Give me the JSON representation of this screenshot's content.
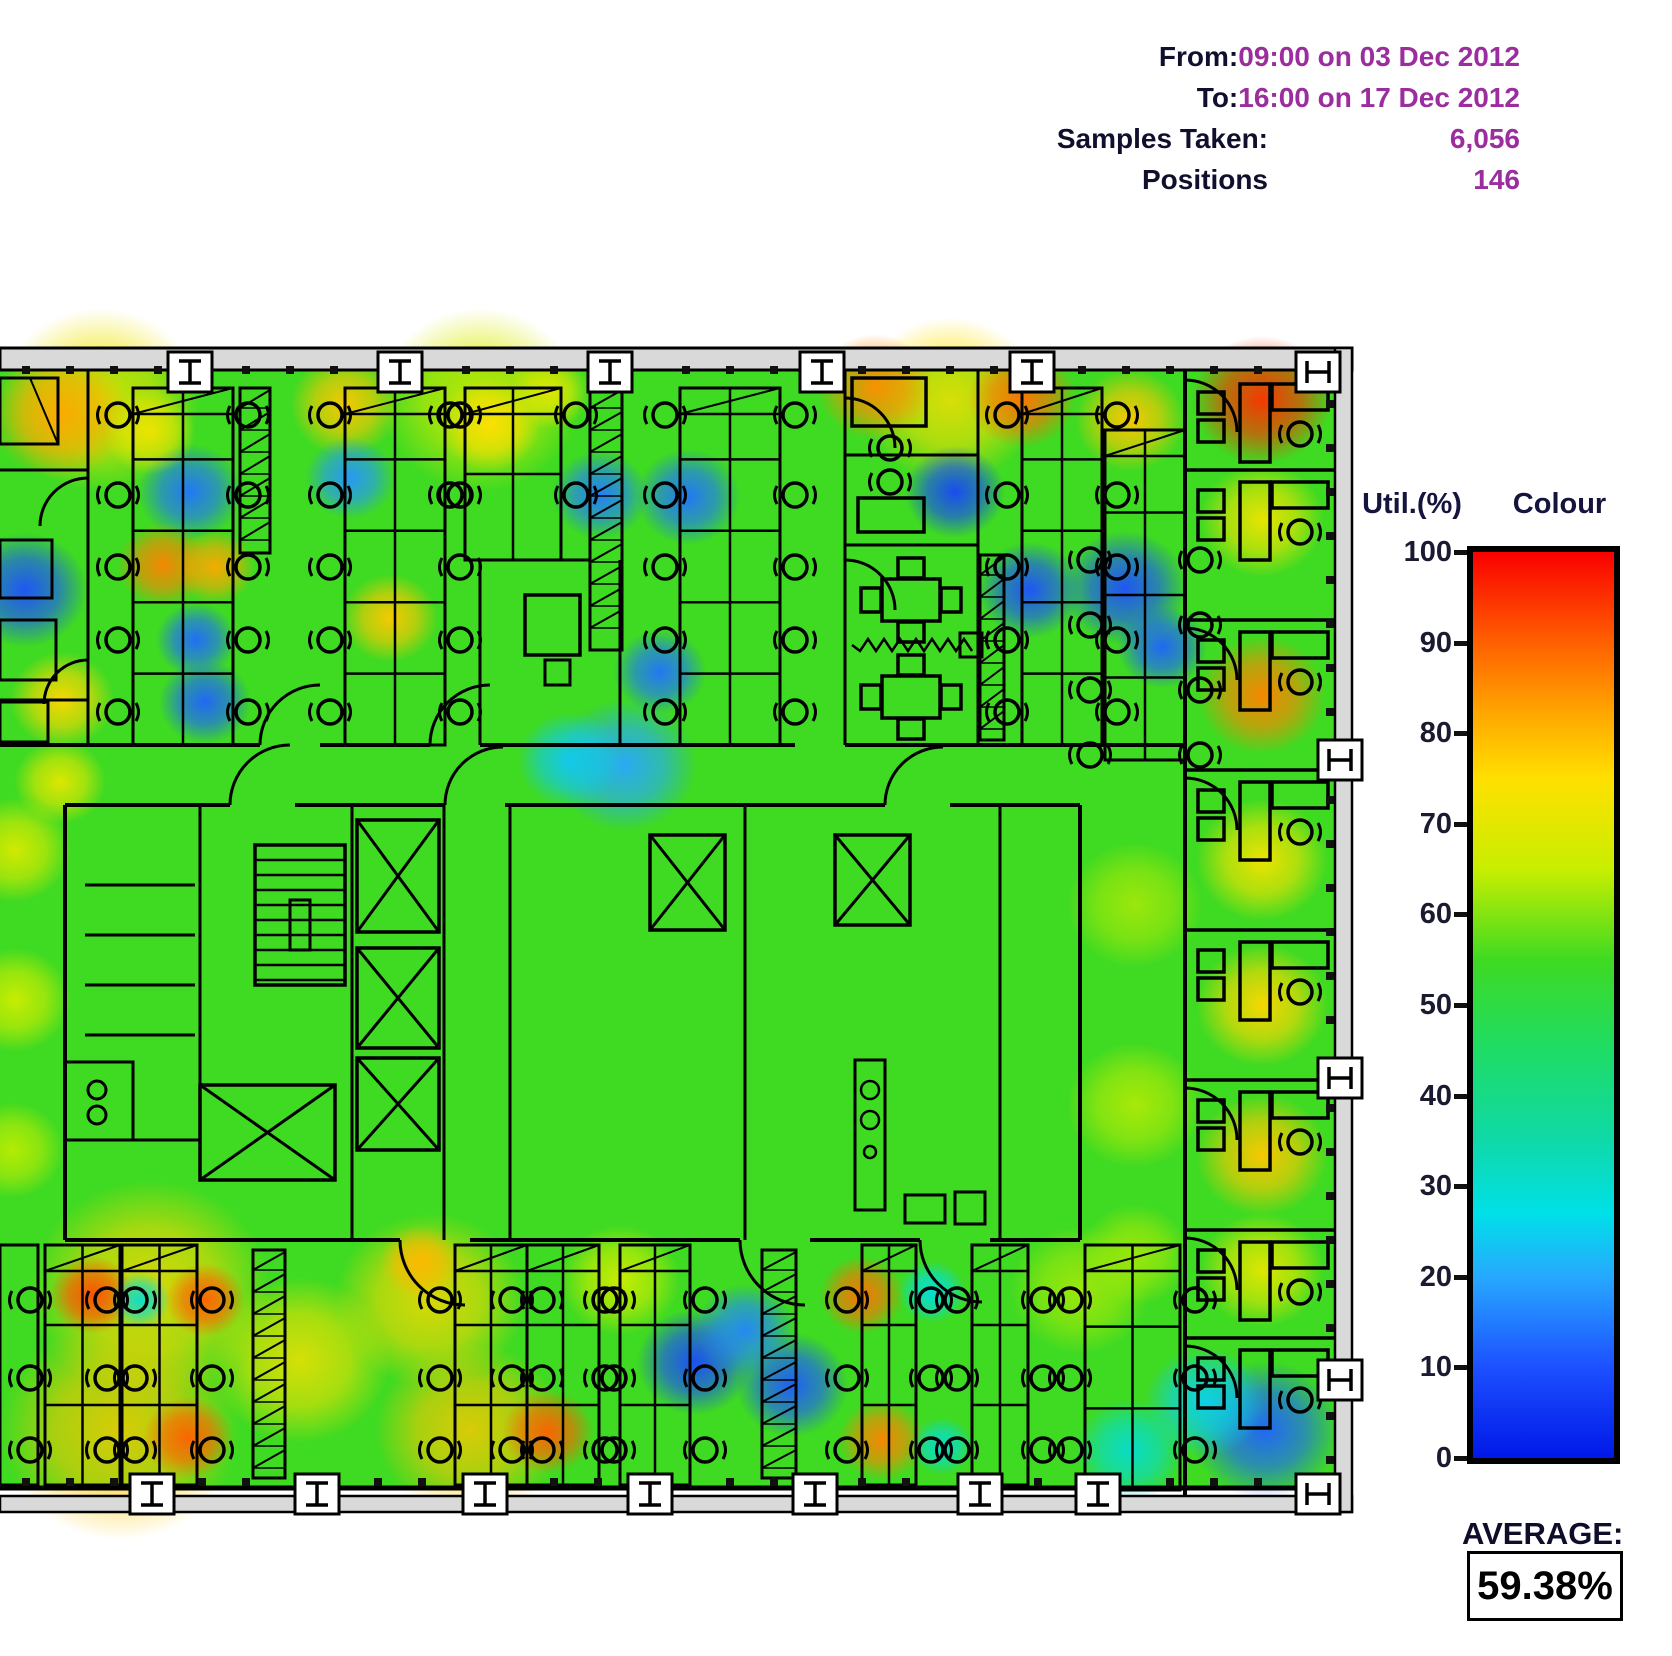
{
  "header": {
    "rows": [
      {
        "label": "From:",
        "value": "09:00 on 03 Dec 2012"
      },
      {
        "label": "To:",
        "value": "16:00 on 17 Dec 2012"
      },
      {
        "label": "Samples Taken:",
        "value": "6,056"
      },
      {
        "label": "Positions",
        "value": "146"
      }
    ]
  },
  "legend": {
    "util_label": "Util.(%)",
    "colour_label": "Colour",
    "ticks": [
      100,
      90,
      80,
      70,
      60,
      50,
      40,
      30,
      20,
      10,
      0
    ]
  },
  "average": {
    "label": "AVERAGE:",
    "value": "59.38%"
  },
  "colors": {
    "value_text": "#9b2d9e",
    "label_text": "#10102e",
    "plan_line": "#000000",
    "wall_grey": "#d9d9d9"
  },
  "chart_data": {
    "type": "heatmap",
    "title": "Desk utilisation heatmap over office floor plan",
    "period_from": "09:00 on 03 Dec 2012",
    "period_to": "16:00 on 17 Dec 2012",
    "samples_taken": 6056,
    "positions": 146,
    "average_util_pct": 59.38,
    "scale": {
      "min": 0,
      "max": 100,
      "unit": "%",
      "colormap": "jet",
      "stops": [
        [
          0,
          "#0018e8"
        ],
        [
          10,
          "#1d50ff"
        ],
        [
          20,
          "#27a8ff"
        ],
        [
          27,
          "#00e0e8"
        ],
        [
          35,
          "#0fd9a8"
        ],
        [
          45,
          "#1edc66"
        ],
        [
          55,
          "#3fda22"
        ],
        [
          65,
          "#c8ee00"
        ],
        [
          75,
          "#ffe000"
        ],
        [
          82,
          "#ffa800"
        ],
        [
          90,
          "#ff6000"
        ],
        [
          100,
          "#fa0000"
        ]
      ]
    },
    "base_util": 55,
    "points": [
      [
        100,
        400,
        100,
        72
      ],
      [
        480,
        400,
        100,
        68
      ],
      [
        950,
        400,
        90,
        75
      ],
      [
        150,
        1290,
        120,
        76
      ],
      [
        120,
        1430,
        120,
        78
      ],
      [
        430,
        1300,
        95,
        76
      ],
      [
        470,
        1430,
        95,
        78
      ],
      [
        300,
        1360,
        90,
        74
      ],
      [
        60,
        415,
        70,
        82
      ],
      [
        150,
        432,
        46,
        72
      ],
      [
        345,
        405,
        55,
        78
      ],
      [
        490,
        425,
        50,
        75
      ],
      [
        550,
        392,
        40,
        70
      ],
      [
        875,
        387,
        58,
        85
      ],
      [
        1022,
        398,
        54,
        88
      ],
      [
        1130,
        420,
        55,
        78
      ],
      [
        1262,
        400,
        70,
        95
      ],
      [
        25,
        590,
        62,
        10
      ],
      [
        190,
        492,
        52,
        14
      ],
      [
        350,
        478,
        45,
        18
      ],
      [
        600,
        495,
        48,
        15
      ],
      [
        688,
        497,
        52,
        14
      ],
      [
        955,
        492,
        50,
        8
      ],
      [
        1030,
        590,
        52,
        10
      ],
      [
        1125,
        588,
        62,
        10
      ],
      [
        1162,
        647,
        45,
        12
      ],
      [
        163,
        565,
        46,
        86
      ],
      [
        215,
        567,
        40,
        82
      ],
      [
        390,
        618,
        48,
        78
      ],
      [
        62,
        700,
        52,
        76
      ],
      [
        196,
        640,
        40,
        13
      ],
      [
        205,
        702,
        46,
        12
      ],
      [
        660,
        672,
        46,
        14
      ],
      [
        570,
        760,
        52,
        24
      ],
      [
        625,
        765,
        72,
        20
      ],
      [
        1262,
        520,
        62,
        72
      ],
      [
        1262,
        695,
        64,
        86
      ],
      [
        15,
        850,
        56,
        68
      ],
      [
        15,
        1000,
        56,
        66
      ],
      [
        12,
        1150,
        52,
        64
      ],
      [
        60,
        782,
        46,
        70
      ],
      [
        1135,
        905,
        68,
        62
      ],
      [
        1135,
        1105,
        68,
        63
      ],
      [
        1135,
        1255,
        55,
        62
      ],
      [
        1262,
        860,
        66,
        73
      ],
      [
        1262,
        1005,
        66,
        76
      ],
      [
        1262,
        1155,
        66,
        78
      ],
      [
        1262,
        1270,
        62,
        70
      ],
      [
        620,
        1280,
        60,
        66
      ],
      [
        1080,
        1290,
        70,
        62
      ],
      [
        92,
        1295,
        42,
        92
      ],
      [
        205,
        1300,
        40,
        90
      ],
      [
        188,
        1438,
        45,
        90
      ],
      [
        548,
        1432,
        46,
        90
      ],
      [
        862,
        1295,
        42,
        88
      ],
      [
        882,
        1440,
        44,
        86
      ],
      [
        420,
        1262,
        40,
        80
      ],
      [
        140,
        1300,
        30,
        30
      ],
      [
        932,
        1292,
        34,
        28
      ],
      [
        942,
        1446,
        32,
        30
      ],
      [
        695,
        1362,
        58,
        9
      ],
      [
        792,
        1385,
        56,
        11
      ],
      [
        745,
        1330,
        50,
        16
      ],
      [
        1265,
        1430,
        75,
        12
      ],
      [
        1205,
        1402,
        60,
        25
      ],
      [
        1130,
        1450,
        55,
        30
      ]
    ]
  }
}
